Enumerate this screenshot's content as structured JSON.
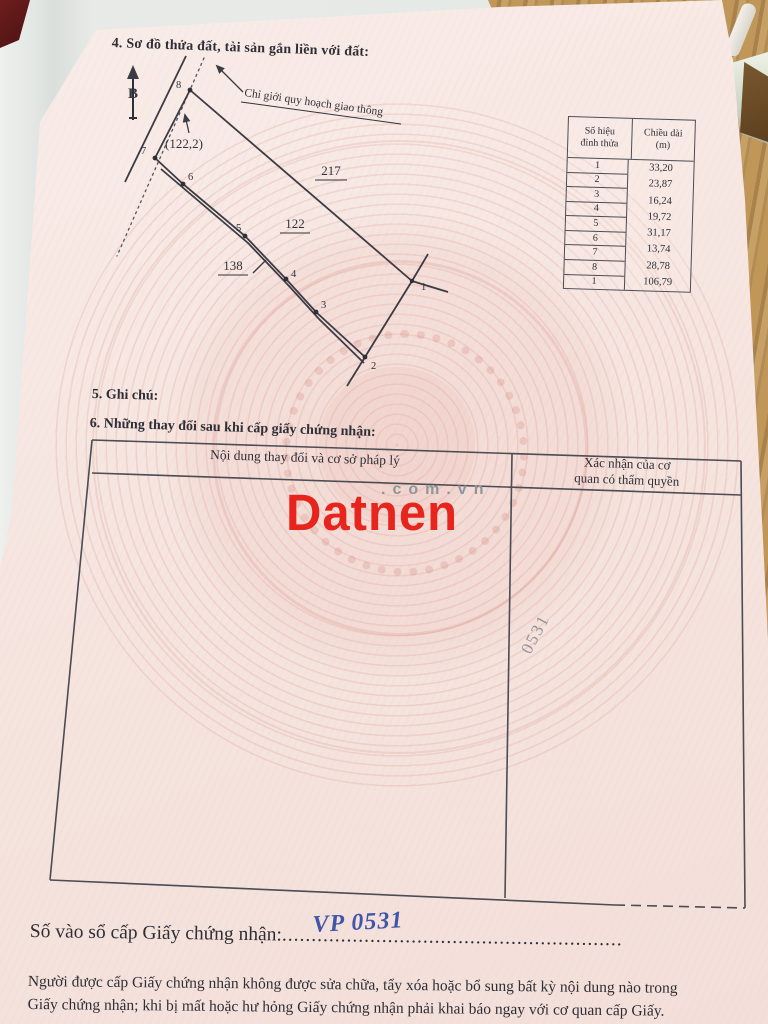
{
  "colors": {
    "watermark_red": "#e8251d",
    "handwriting_blue": "#4056a8",
    "page_pink": "#f6e5e0"
  },
  "page": {
    "section4_title": "4. Sơ đồ thửa đất, tài sản gắn liền với đất:",
    "section5_title": "5. Ghi chú:",
    "section6_title": "6. Những thay đổi sau khi cấp giấy chứng nhận:",
    "register_label": "Số vào sổ cấp Giấy chứng nhận:",
    "register_dots": "..........................................................",
    "register_number": "VP 0531",
    "footer_line1": "Người được cấp Giấy chứng nhận không được sửa chữa, tẩy xóa hoặc bổ sung bất kỳ nội dung nào trong",
    "footer_line2": "Giấy chứng nhận; khi bị mất hoặc hư hỏng Giấy chứng nhận phải khai báo ngay với cơ quan cấp Giấy."
  },
  "diagram": {
    "north_label": "B",
    "planning_line_label": "Chỉ giới quy hoạch giao thông",
    "inner_note": "(122,2)",
    "parcel_top": "217",
    "parcel_mid": "122",
    "parcel_low": "138",
    "vertex_labels": [
      "1",
      "2",
      "3",
      "4",
      "5",
      "6",
      "7",
      "8"
    ]
  },
  "length_table": {
    "header_col1_line1": "Số hiệu",
    "header_col1_line2": "đỉnh thửa",
    "header_col2_line1": "Chiều dài",
    "header_col2_line2": "(m)",
    "vertices": [
      "1",
      "2",
      "3",
      "4",
      "5",
      "6",
      "7",
      "8",
      "1"
    ],
    "lengths": [
      "33,20",
      "23,87",
      "16,24",
      "19,72",
      "31,17",
      "13,74",
      "28,78",
      "106,79"
    ]
  },
  "changes_table": {
    "col1_header": "Nội dung thay đổi và cơ sở pháp lý",
    "col2_header_line1": "Xác nhận của cơ",
    "col2_header_line2": "quan có thẩm quyền",
    "handwritten_note": "0531"
  },
  "watermark": {
    "brand": "Datnen",
    "suffix": ".com.vn"
  }
}
